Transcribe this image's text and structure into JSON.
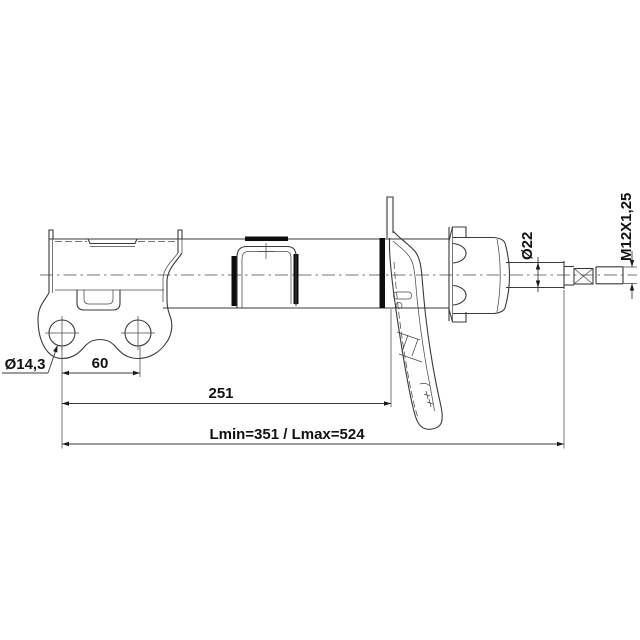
{
  "drawing": {
    "dimensions": {
      "hole_diameter": "Ø14,3",
      "hole_spacing": "60",
      "mount_length": "251",
      "length_range": "Lmin=351 / Lmax=524",
      "rod_diameter": "Ø22",
      "thread_spec": "M12X1,25"
    },
    "colors": {
      "line": "#3a3a3a",
      "fill_black": "#0d0d0d",
      "background": "#ffffff"
    }
  }
}
